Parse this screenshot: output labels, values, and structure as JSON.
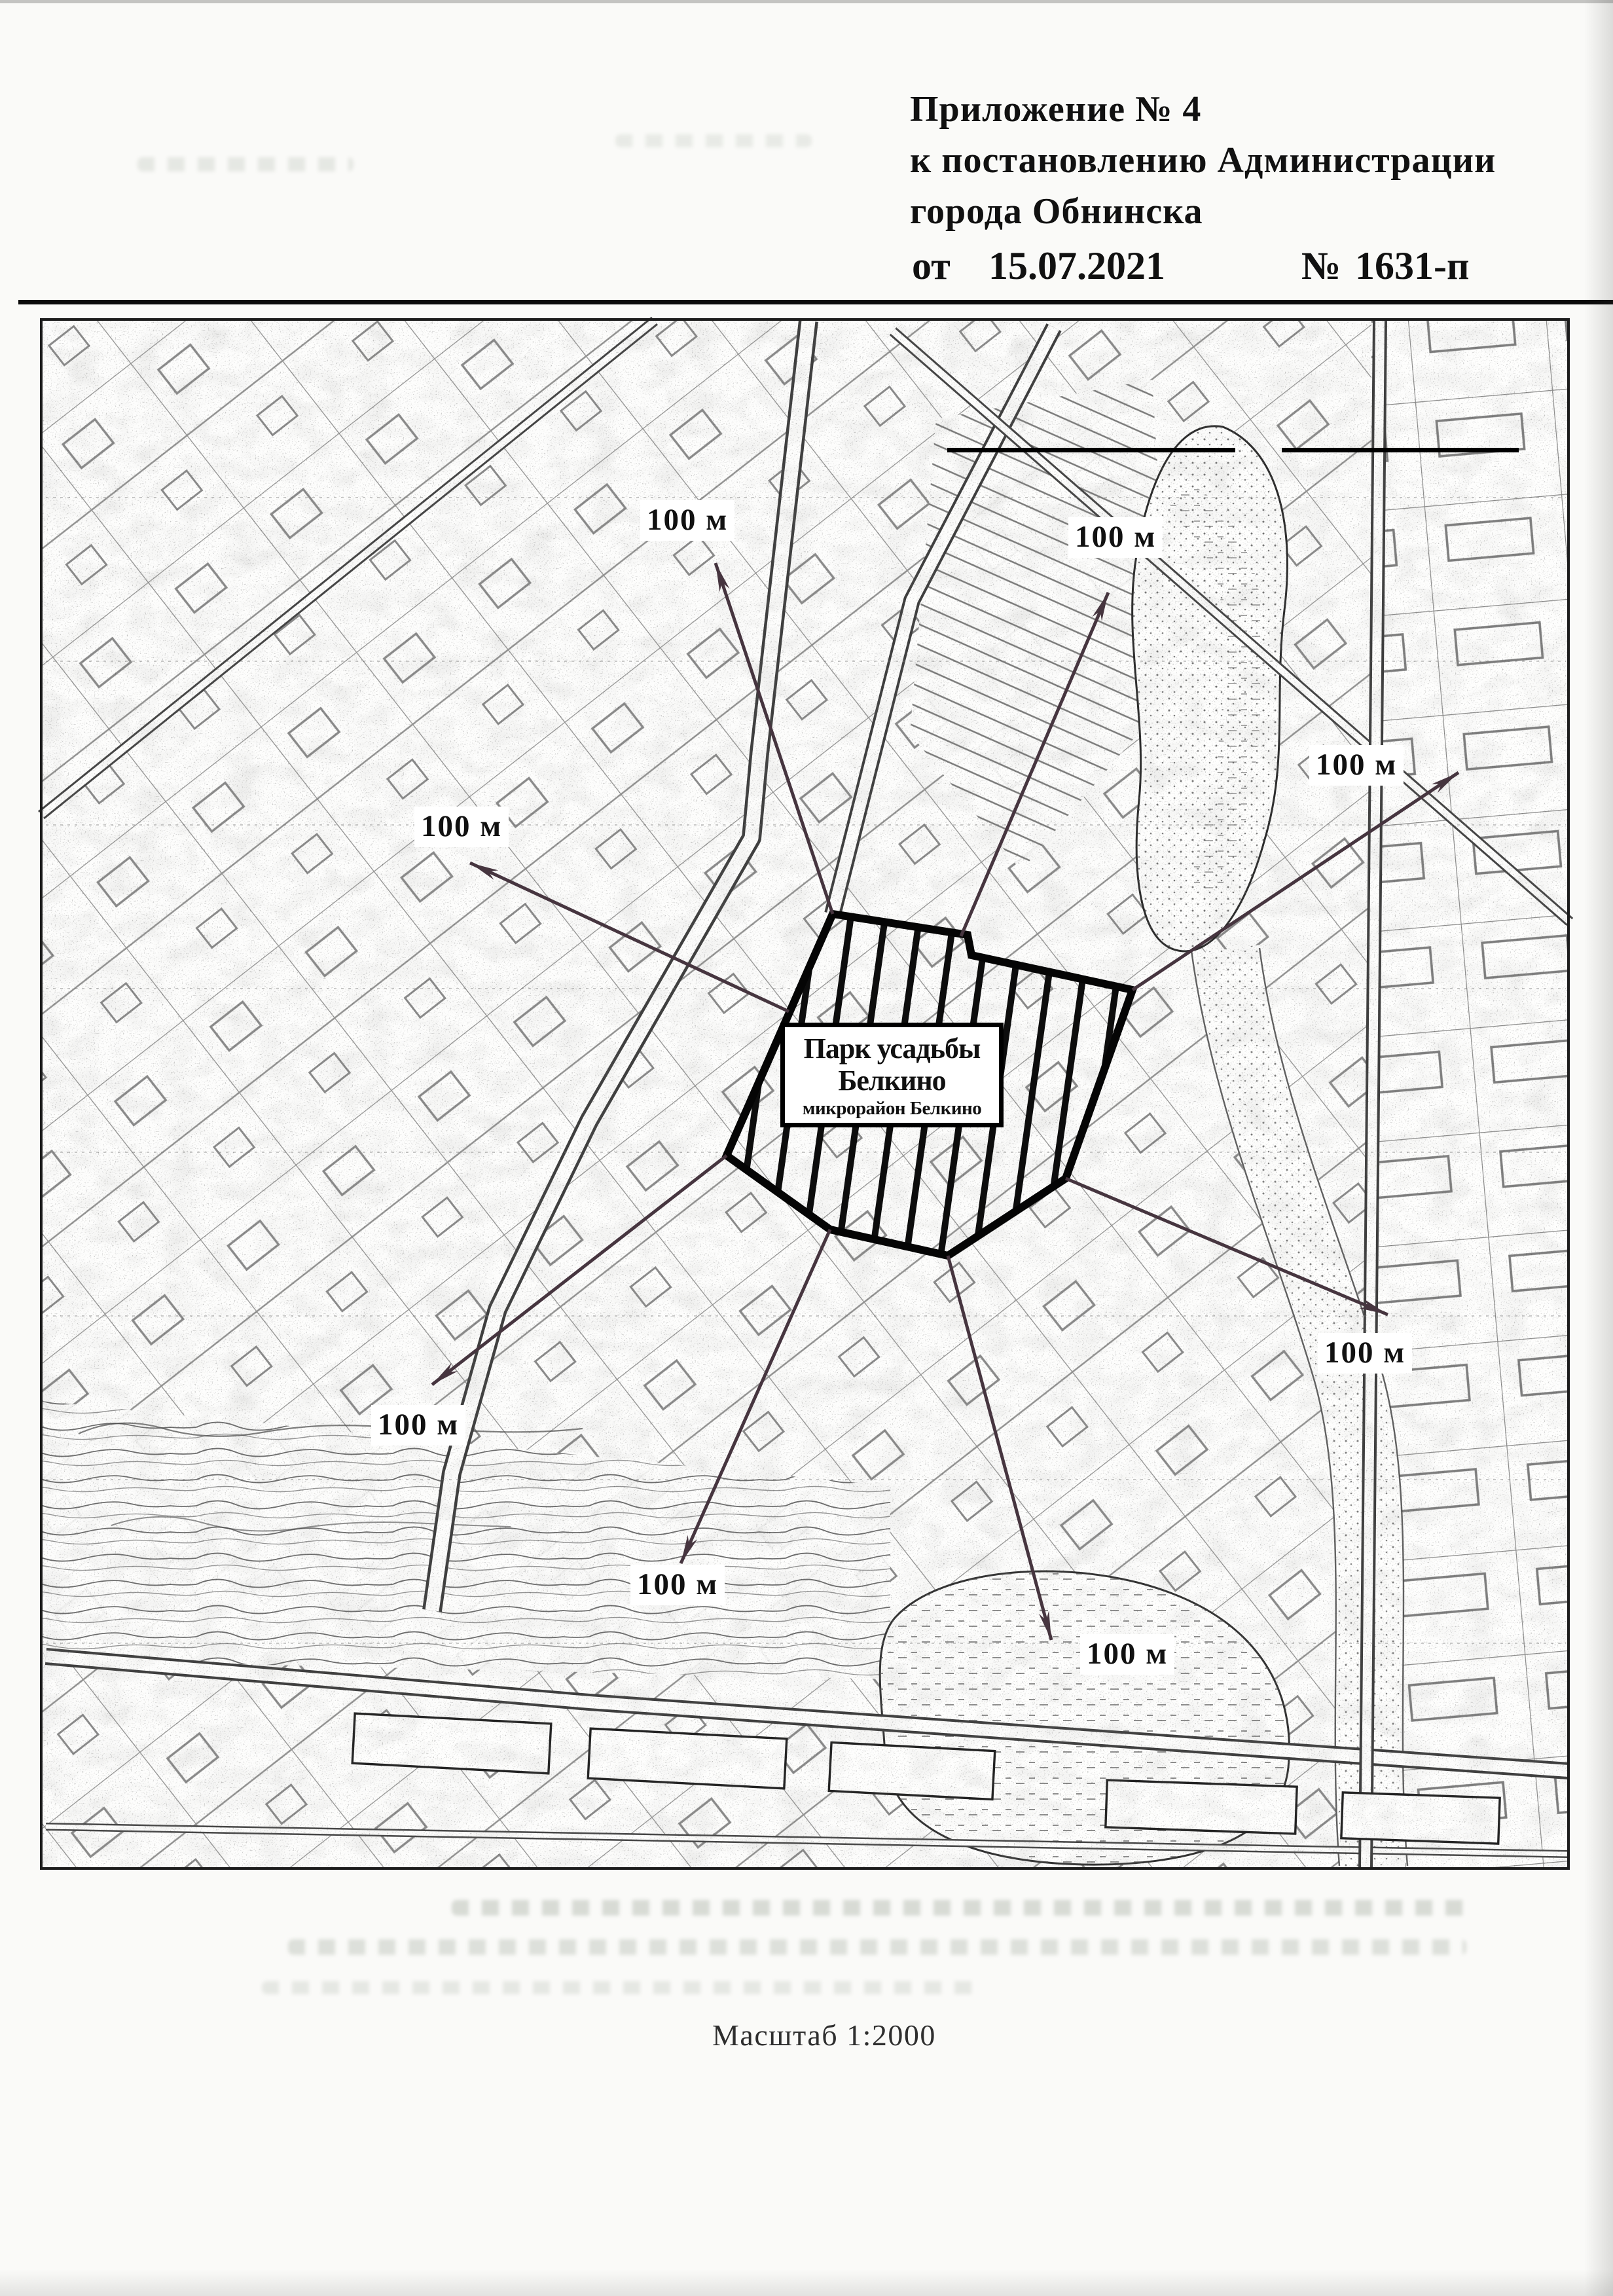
{
  "page": {
    "header": {
      "line1": "Приложение № 4",
      "line2": "к постановлению Администрации",
      "line3": "города  Обнинска",
      "from_label": "от",
      "date": "15.07.2021",
      "number_label": "№",
      "number": "1631-п"
    },
    "scale_caption": "Масштаб 1:2000"
  },
  "map": {
    "site": {
      "name_line1": "Парк усадьбы",
      "name_line2": "Белкино",
      "name_line3": "микрорайон Белкино"
    },
    "distance_labels": [
      {
        "text": "100 м"
      },
      {
        "text": "100 м"
      },
      {
        "text": "100 м"
      },
      {
        "text": "100 м"
      },
      {
        "text": "100 м"
      },
      {
        "text": "100 м"
      },
      {
        "text": "100 м"
      },
      {
        "text": "100 м"
      }
    ]
  },
  "colors": {
    "ink": "#111111",
    "arrow": "#46353f",
    "paper": "#fafaf8"
  }
}
